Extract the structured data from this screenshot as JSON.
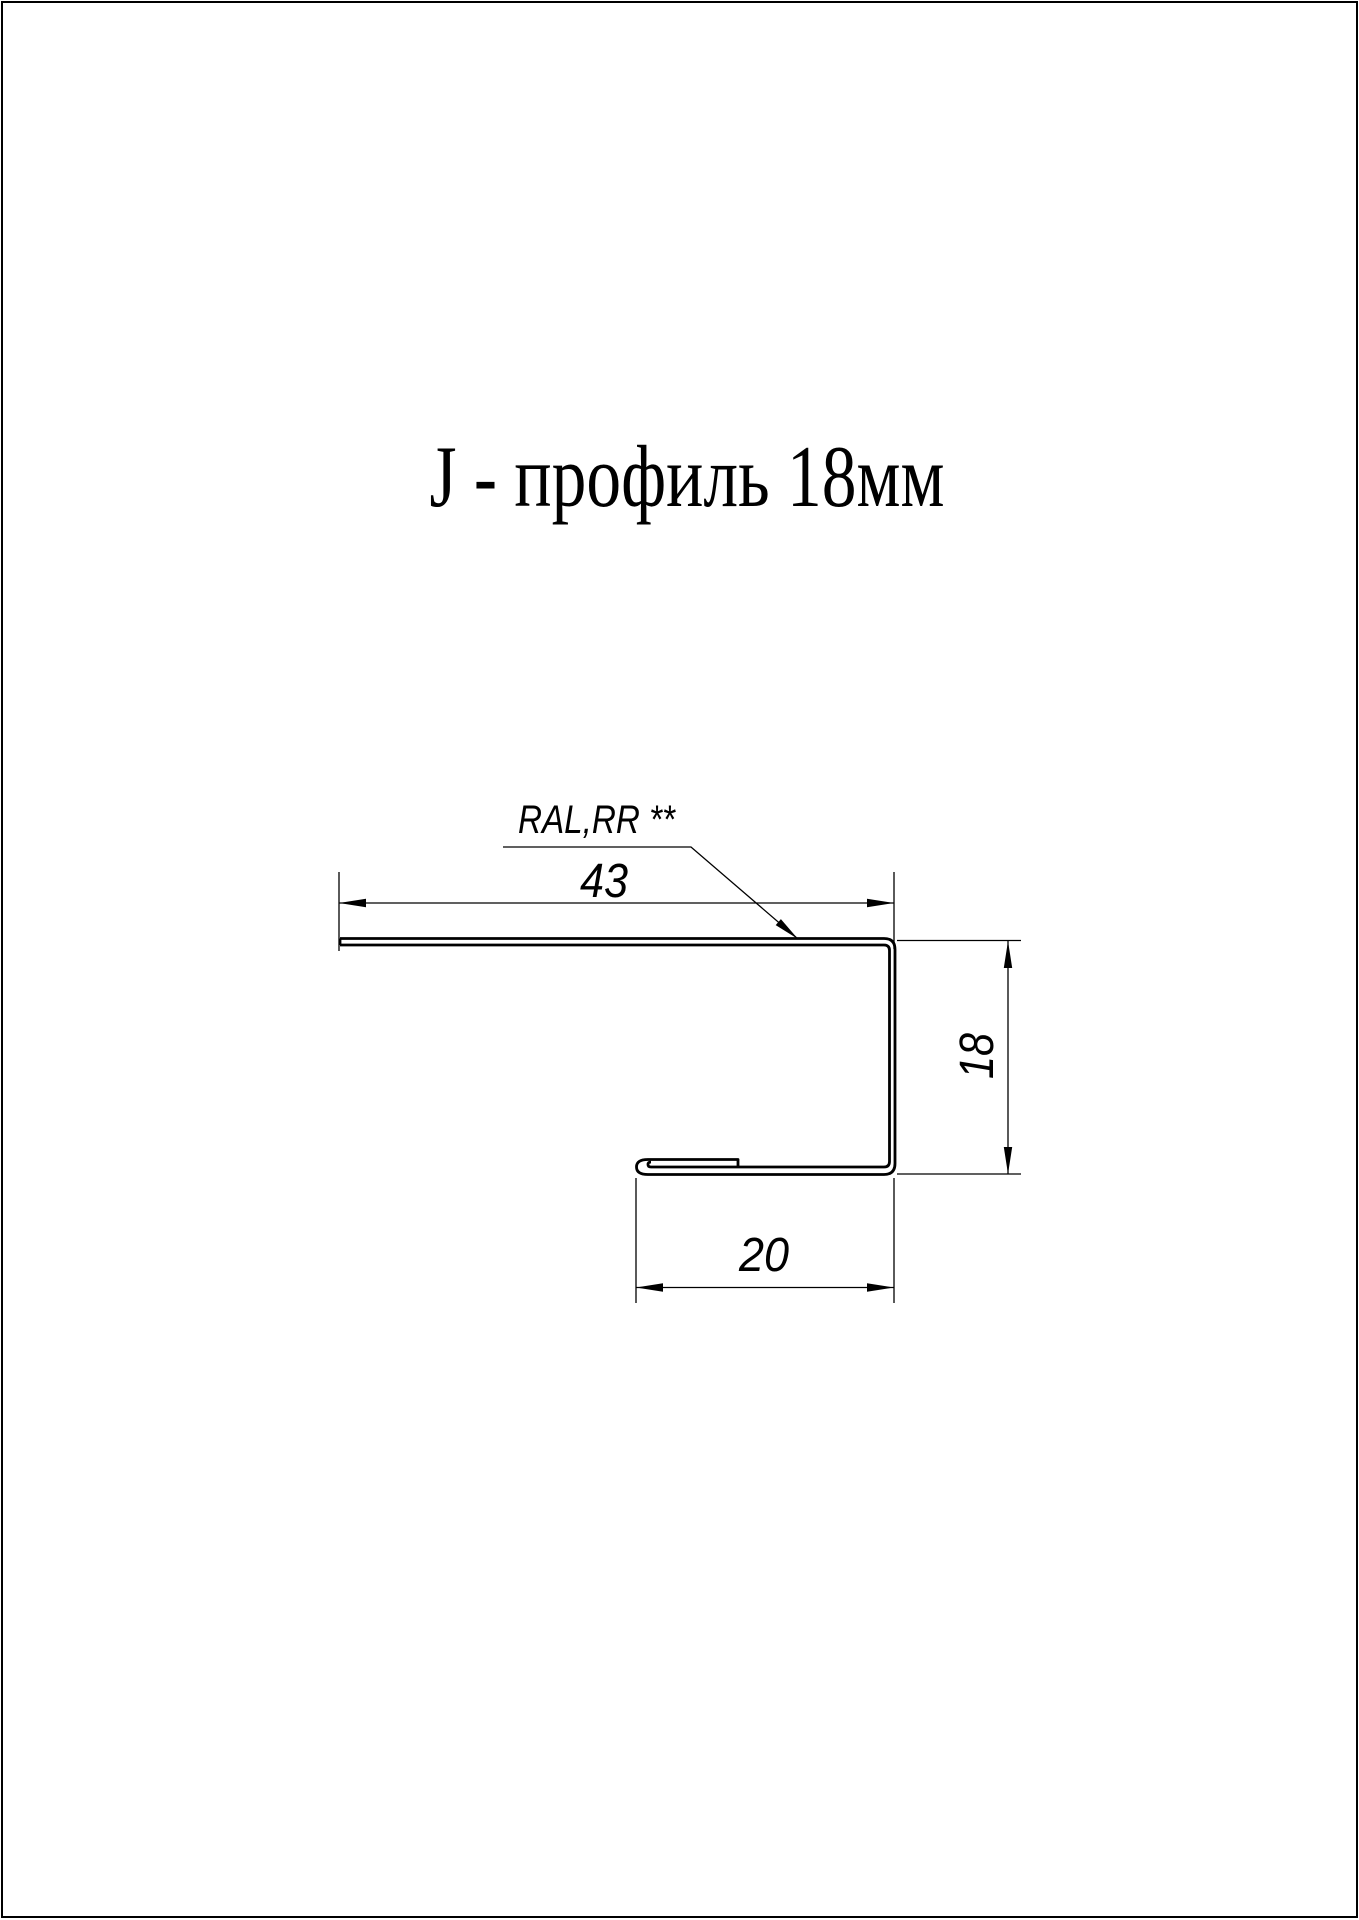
{
  "page": {
    "title": "J - профиль 18мм",
    "background_color": "#ffffff",
    "line_color": "#000000"
  },
  "drawing": {
    "material_label": "RAL,RR **",
    "dimensions": {
      "top_width": "43",
      "height": "18",
      "bottom_width": "20"
    }
  }
}
